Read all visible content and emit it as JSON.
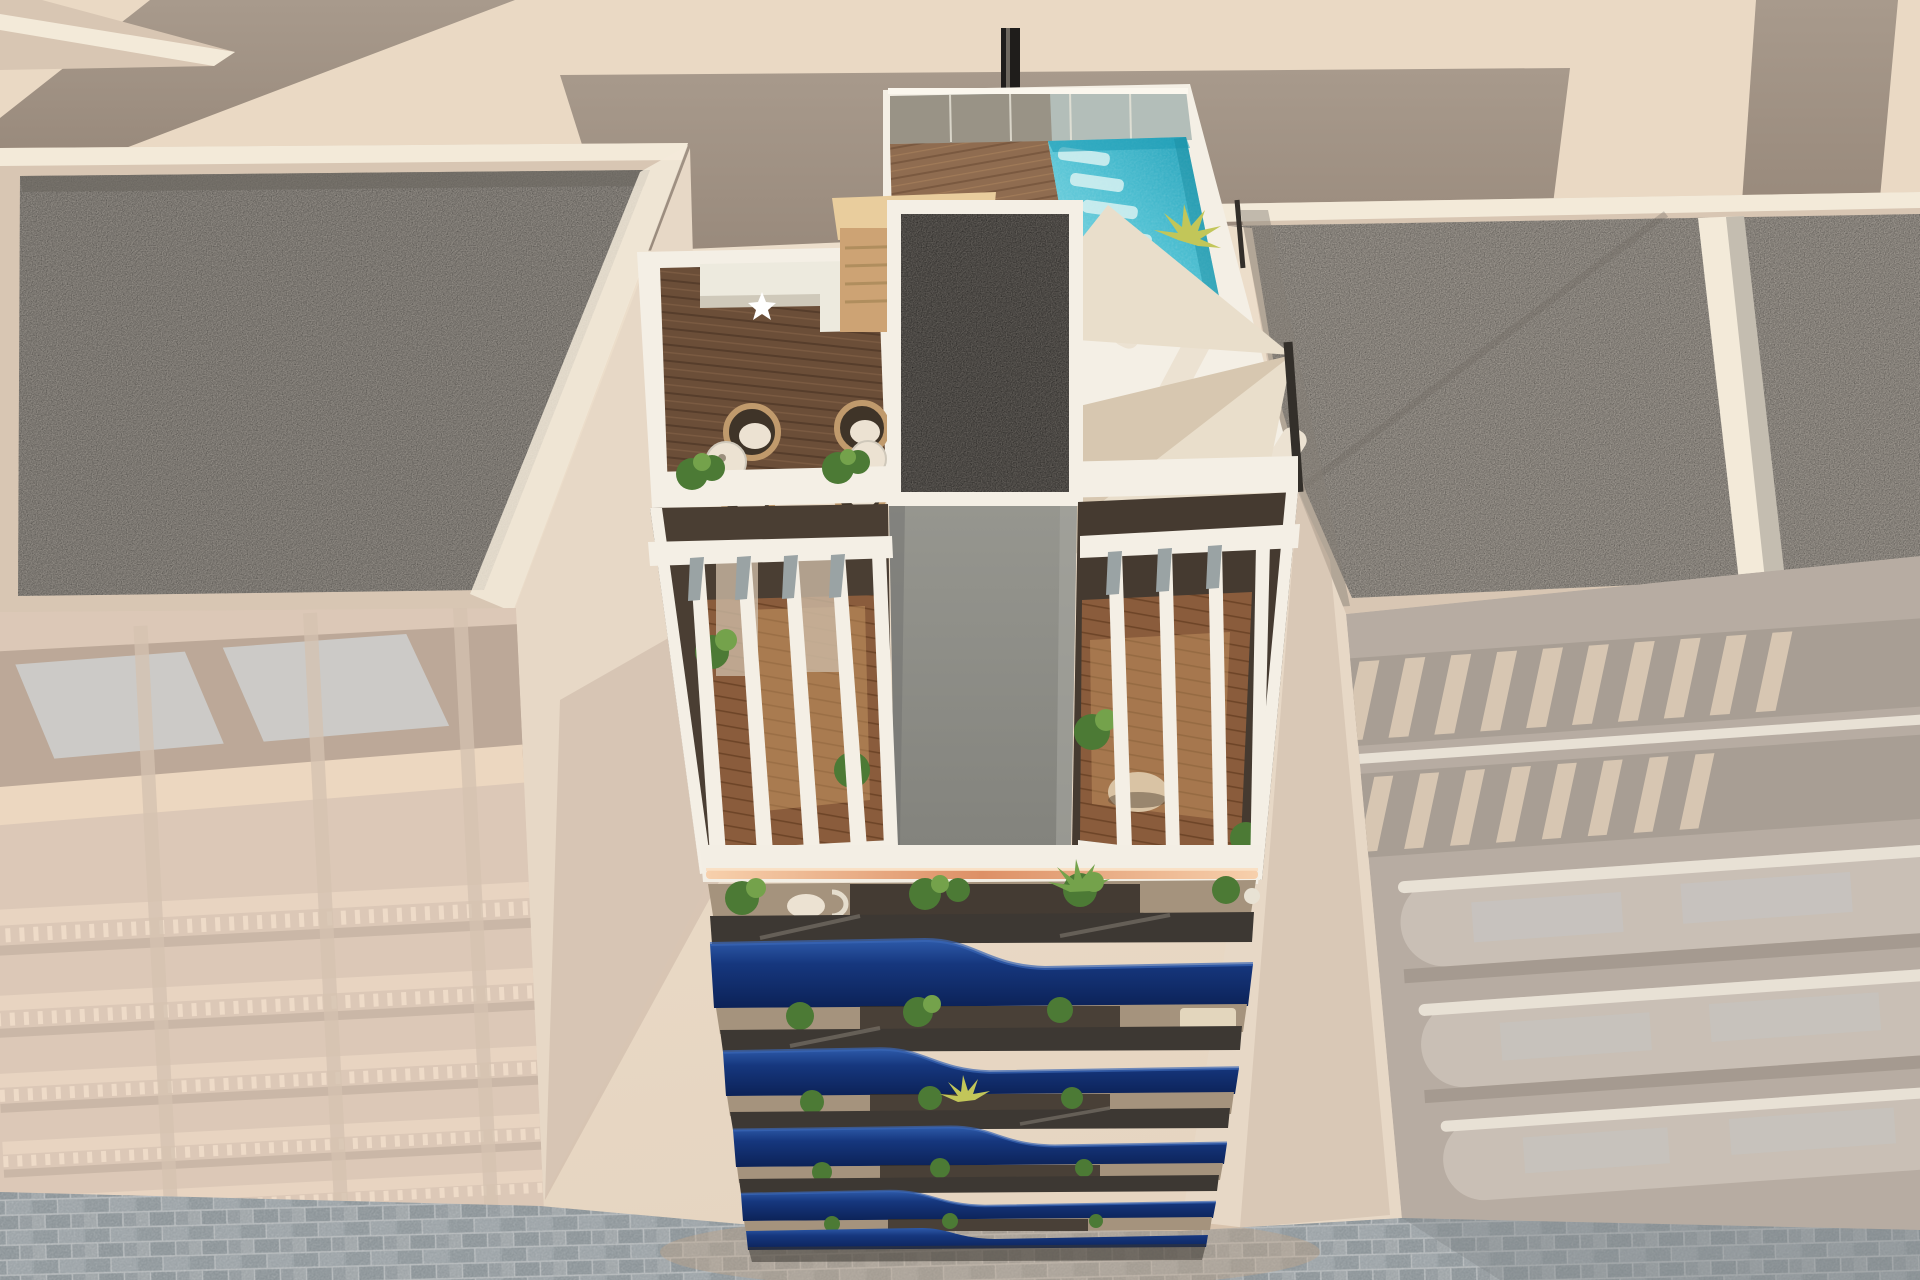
{
  "meta": {
    "description": "Aerial 3D architectural render of a new-build apartment tower with rooftop pool terrace and wavy navy-blue balconies, flanked by desaturated neighbouring buildings over a cobbled street",
    "balcony_floors": 5,
    "shade_sails": 3,
    "sun_loungers": 4,
    "hanging_egg_chairs": 4,
    "pergola_wings": 2
  },
  "scene": {
    "hero_building": {
      "rooftop": [
        "swimming-pool",
        "glass-balustrade",
        "wood-deck",
        "sauna-cabin",
        "outdoor-kitchen",
        "hanging-egg-chairs",
        "side-tables",
        "planter-ledge",
        "shade-sails",
        "sun-loungers",
        "palm-plants",
        "chimney"
      ],
      "core": "elevator-core-with-gravel-roof",
      "pergola_level": [
        "white-slat-pergola-left",
        "white-slat-pergola-right",
        "round-table",
        "interior-wood-floor"
      ],
      "facade": [
        "white-fascia",
        "copper-led-strip",
        "wave-balcony-1",
        "wave-balcony-2",
        "wave-balcony-3",
        "wave-balcony-4",
        "wave-balcony-5",
        "balcony-plants"
      ]
    },
    "neighbours": {
      "left": [
        "gravel-roof",
        "balustrade-facade"
      ],
      "right": [
        "gravel-roof",
        "slatted-roof-terraces",
        "curved-balcony-facade"
      ]
    },
    "ground": "cobblestone-street"
  },
  "colors": {
    "bg_top": "#efe2cf",
    "bg_warm": "#e6d5c1",
    "ground_cream": "#ead9c4",
    "wall_band": "#a89a8c",
    "wall_band_dark": "#998a7c",
    "parapet_beige": "#d8c6b3",
    "parapet_white": "#f3ead9",
    "gravel_left": "#8f8a83",
    "gravel_right": "#9a948c",
    "gravel_dark": "#6e6a63",
    "core_gravel": "#5e5a55",
    "core_shaft": "#96968f",
    "core_shaft_dark": "#83837d",
    "white_trim": "#f4efe5",
    "white_soft": "#e9e3d6",
    "glass_rail": "#a3b2ae",
    "pool_light": "#9ae2ea",
    "pool_mid": "#4fc0d2",
    "pool_deep": "#1e9cb5",
    "deck_dark": "#6b4e38",
    "deck_light": "#8f6c50",
    "wood_floor": "#8a5c3c",
    "wood_lit": "#c89a64",
    "sauna_wood": "#cda374",
    "sauna_roof": "#e9cd9d",
    "sauna_door": "#7a5434",
    "counter_white": "#edeade",
    "rattan": "#c09a6c",
    "cushion_white": "#ece2d2",
    "plant_green": "#4c7a35",
    "plant_light": "#74a24b",
    "palm_yellow": "#c2c659",
    "sail_cream": "#e9decb",
    "sail_shade": "#d7c7b0",
    "pole_dark": "#332f2a",
    "chimney_black": "#1f1d1b",
    "fascia_white": "#f3eee4",
    "copper": "#dd9066",
    "copper_glow": "#f7d0ac",
    "balcony_floor": "#a5937d",
    "doorway_dark": "#322c26",
    "glass_strip": "#3d3833",
    "navy": "#16377e",
    "navy_light": "#2d5aa9",
    "navy_dark": "#0c2257",
    "street": "#98a0a4",
    "street_dark": "#7e8487",
    "street_glow": "#c2a488",
    "shadow_base": "#3a3631",
    "facade_left": "#d9c5b4",
    "facade_left_dark": "#b09c8c",
    "window_pane": "#c4c7c8",
    "sill_cream": "#eed8bf",
    "facade_right": "#b4a99f",
    "facade_right_band": "#a3988e",
    "slat_beige": "#dbc8b2",
    "balcony_curve": "#cabfb5",
    "balcony_rim": "#efe7dc",
    "gap_wall": "#e7d8c6",
    "gap_shadow": "#cbb7a5"
  }
}
